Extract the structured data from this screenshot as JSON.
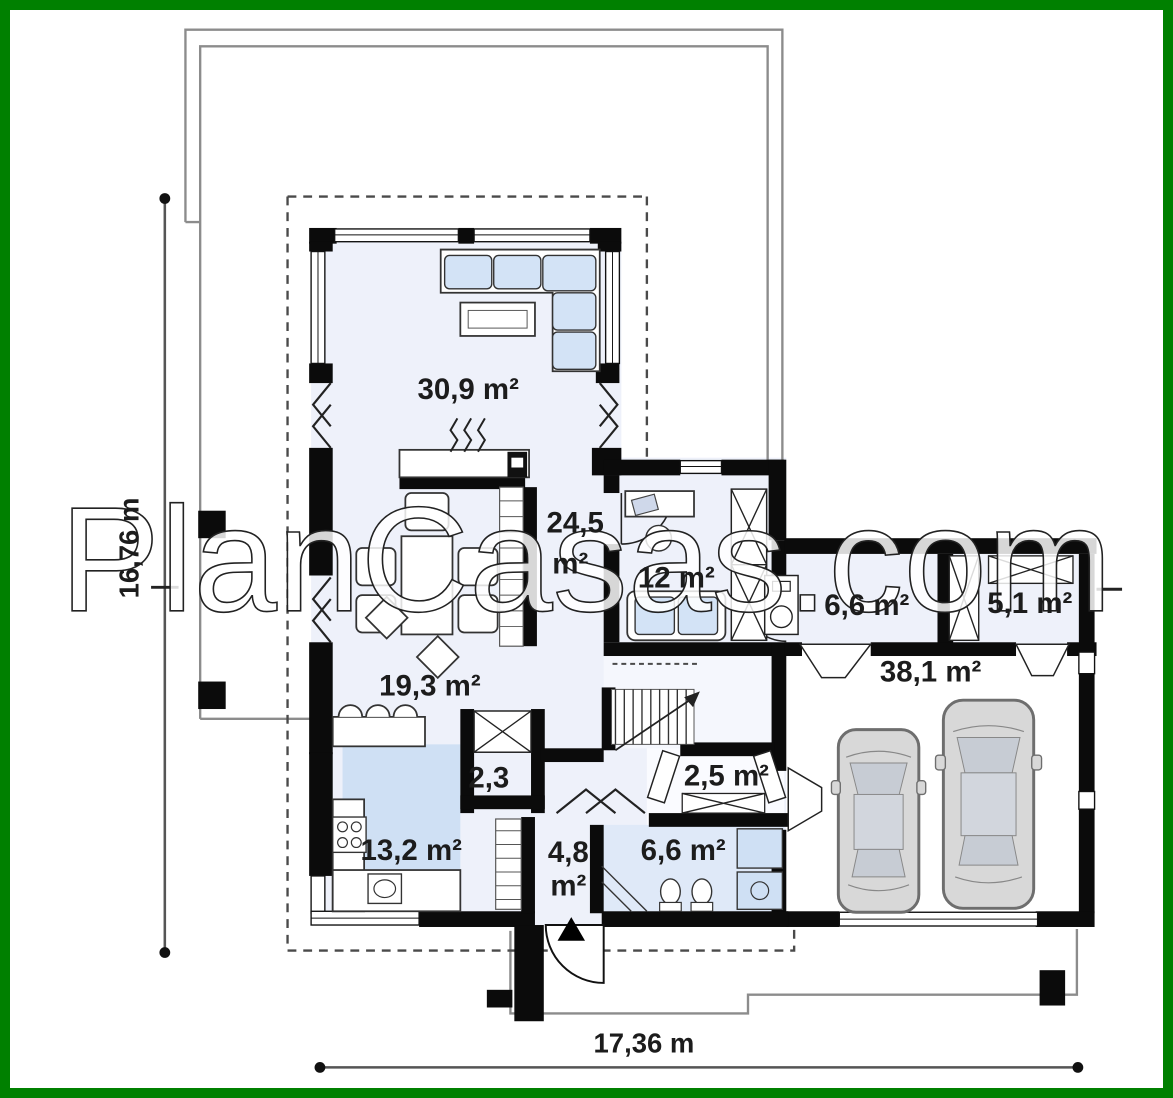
{
  "frame": {
    "border_color": "#008000"
  },
  "watermark": {
    "text": "PlanCasas.com"
  },
  "dimensions": {
    "left_total": "16,76 m",
    "bottom_total": "17,36 m"
  },
  "rooms": {
    "living": {
      "area": "30,9 m²"
    },
    "hall": {
      "area_line1": "24,5",
      "area_line2": "m²"
    },
    "office": {
      "area": "12 m²"
    },
    "utility": {
      "area": "6,6 m²"
    },
    "storage": {
      "area": "5,1 m²"
    },
    "garage": {
      "area": "38,1 m²"
    },
    "dining": {
      "area": "19,3 m²"
    },
    "closet": {
      "area": "2,3"
    },
    "hall_wardrobe": {
      "area": "2,5 m²"
    },
    "kitchen": {
      "area": "13,2 m²"
    },
    "entry": {
      "area_line1": "4,8",
      "area_line2": "m²"
    },
    "bathroom": {
      "area": "6,6 m²"
    }
  },
  "colors": {
    "frame_green": "#008000",
    "wall_black": "#0b0b0b",
    "floor_light": "#eef1fa",
    "floor_blue": "#cfe0f4",
    "bath_floor": "#dfe9f8",
    "furniture_blue": "#d3e3f6",
    "car_gray": "#d8d8d8",
    "outline_gray": "#8c8c8c",
    "dimension_gray": "#555555",
    "label_text": "#1c1c1c",
    "watermark_fill": "#ffffff"
  }
}
